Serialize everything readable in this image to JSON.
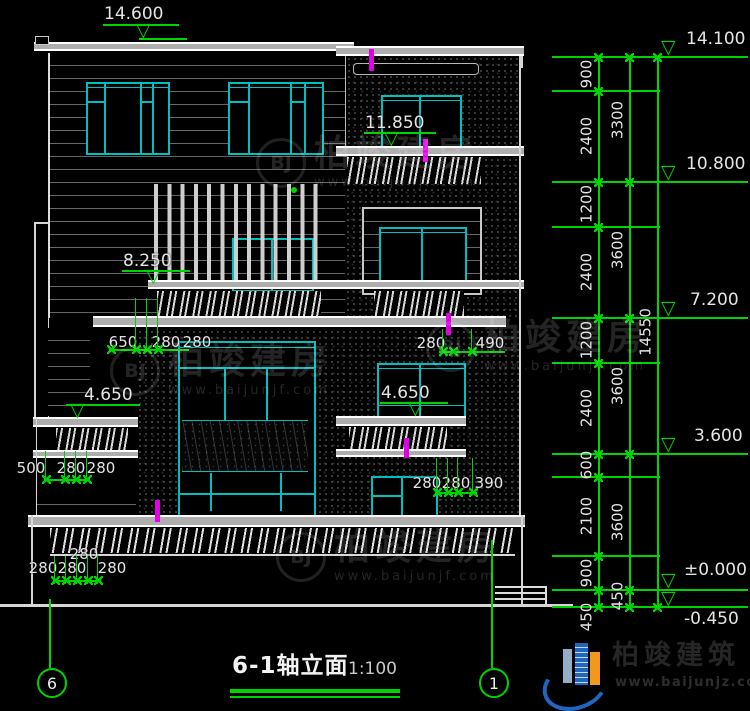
{
  "drawing": {
    "title": "6-1轴立面",
    "scale": "1:100",
    "axis_left": "6",
    "axis_right": "1"
  },
  "icons": {
    "level_triangle": "▽"
  },
  "levels": {
    "roof_left": "14.600",
    "tower_parapet": "14.100",
    "tower_balcony": "11.850",
    "floor3": "10.800",
    "handrail2": "8.250",
    "floor2": "7.200",
    "wing_rail_left": "4.650",
    "wing_rail_right": "4.650",
    "floor1": "3.600",
    "ground": "±0.000",
    "site": "-0.450"
  },
  "dims": {
    "col1": [
      "900",
      "2400",
      "1200",
      "2400",
      "1200",
      "2400",
      "600",
      "2100",
      "900",
      "450"
    ],
    "col2": [
      "3300",
      "3600",
      "3600",
      "3600",
      "450"
    ],
    "total": "14550",
    "g1": [
      "650",
      "280",
      "280"
    ],
    "g2": [
      "280",
      "490"
    ],
    "g3": [
      "500",
      "280",
      "280"
    ],
    "g4_top": "280",
    "g4": [
      "280",
      "280",
      "280"
    ],
    "g5": [
      "280",
      "280",
      "390"
    ]
  },
  "watermark": {
    "monogram": "BJ",
    "name": "柏竣建房",
    "url": "www.baijunjf.com"
  },
  "brand": {
    "name": "柏竣建筑",
    "url": "www.baijunjz.com"
  }
}
